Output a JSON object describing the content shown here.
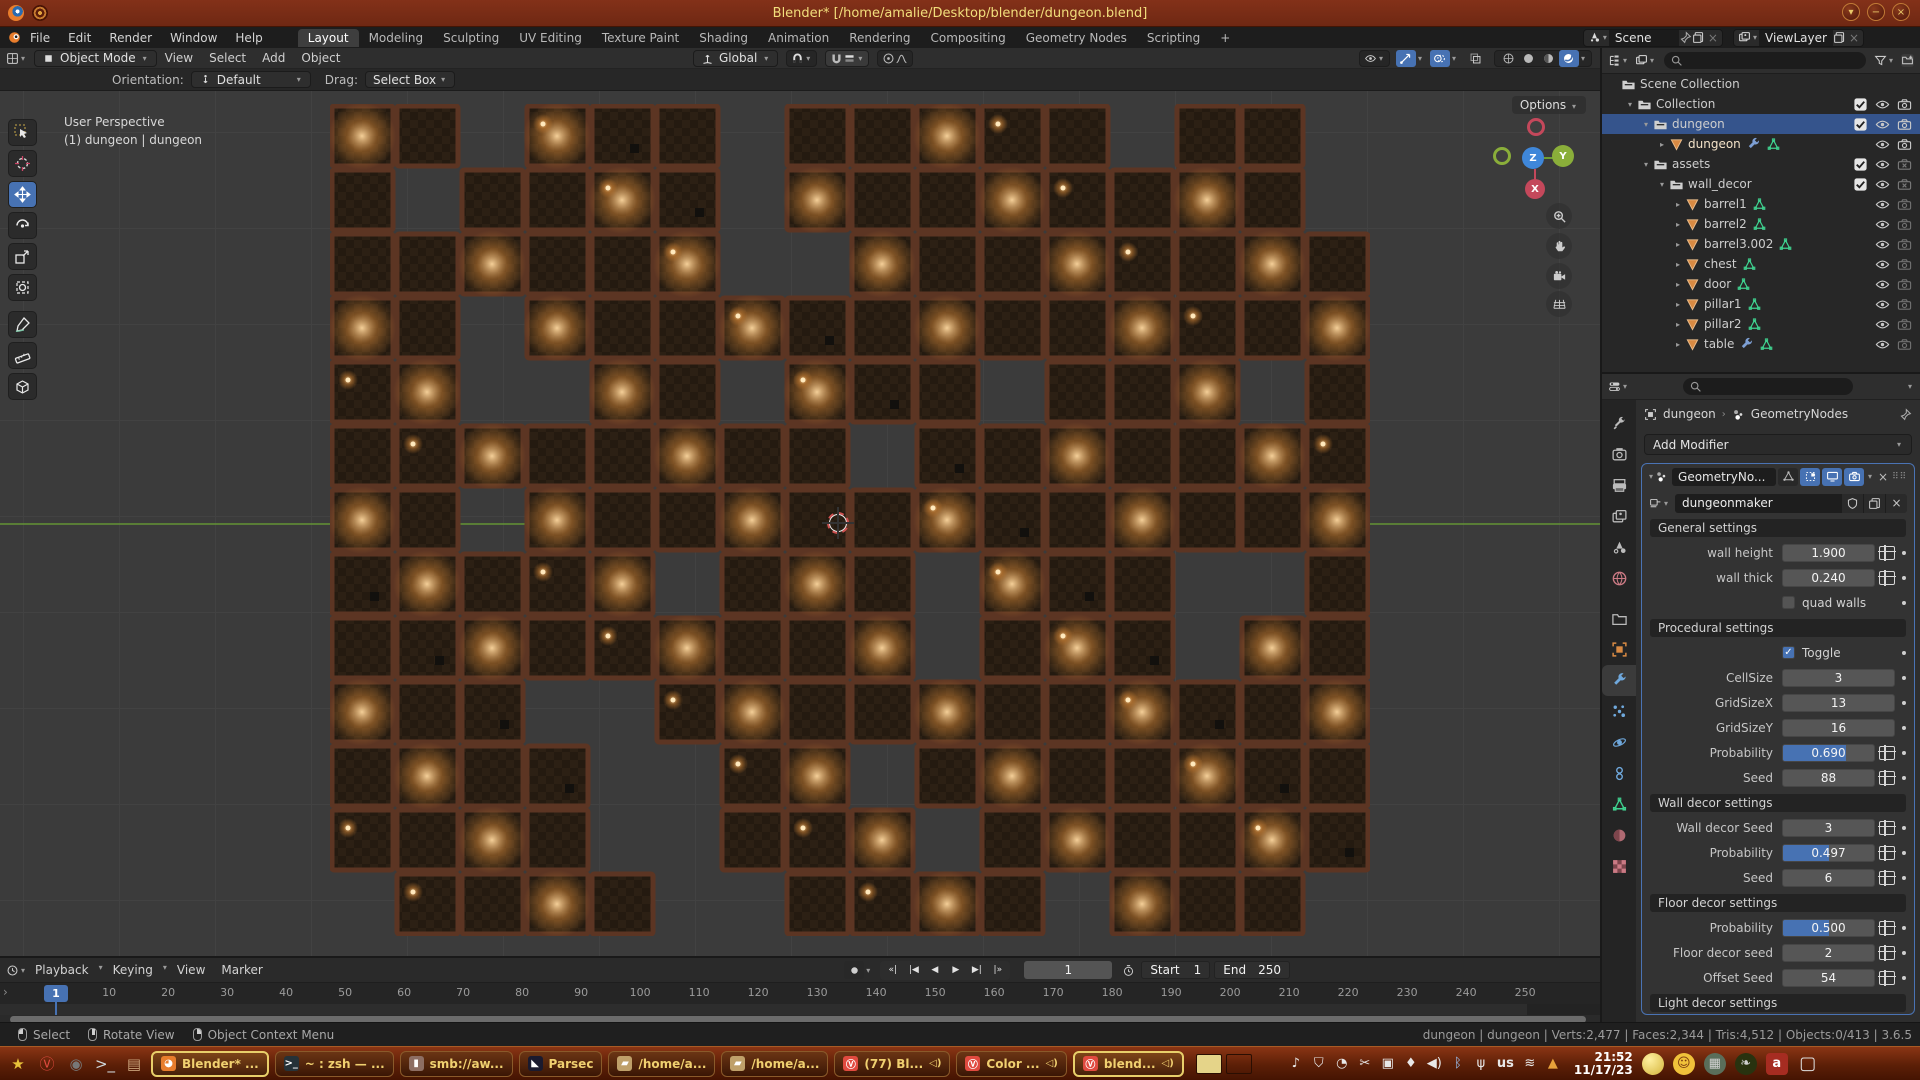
{
  "titlebar": {
    "title": "Blender* [/home/amalie/Desktop/blender/dungeon.blend]",
    "window_buttons": [
      "▾",
      "−",
      "×"
    ]
  },
  "topbar": {
    "menus": [
      "File",
      "Edit",
      "Render",
      "Window",
      "Help"
    ],
    "workspaces": [
      "Layout",
      "Modeling",
      "Sculpting",
      "UV Editing",
      "Texture Paint",
      "Shading",
      "Animation",
      "Rendering",
      "Compositing",
      "Geometry Nodes",
      "Scripting"
    ],
    "active_workspace": "Layout",
    "new_workspace": "+",
    "scene_label": "Scene",
    "viewlayer_label": "ViewLayer"
  },
  "viewport_header": {
    "mode": "Object Mode",
    "menus": [
      "View",
      "Select",
      "Add",
      "Object"
    ],
    "orientation": "Global"
  },
  "tool_settings": {
    "orientation_label": "Orientation:",
    "orientation_value": "Default",
    "drag_label": "Drag:",
    "drag_value": "Select Box",
    "options": "Options"
  },
  "viewport": {
    "overlay_line1": "User Perspective",
    "overlay_line2": "(1) dungeon | dungeon",
    "axis_z": "Z",
    "axis_y": "Y",
    "axis_x": "X",
    "map": {
      "colors": {
        "wall": "#5c3523",
        "floor_a": "#241a10",
        "floor_b": "#2c2014",
        "light_core": "#ffd9a0",
        "light_mid": "#c07a32"
      },
      "grid": [
        "##.###.#####.##.",
        "#.####.########.",
        "######..########",
        "##.#############",
        "##..##.###.###.#",
        "########.#######",
        "##.#############",
        "#####.###.###..#",
        "#########.###.##",
        "###..###########",
        "####..##.#######",
        "####..###.######",
        ".####..####.###."
      ]
    }
  },
  "outliner": {
    "rows": [
      {
        "level": 0,
        "expand": "",
        "icon": "collection",
        "label": "Scene Collection",
        "toggles": []
      },
      {
        "level": 1,
        "expand": "▾",
        "icon": "collection",
        "label": "Collection",
        "toggles": [
          "check",
          "eye",
          "camera"
        ]
      },
      {
        "level": 2,
        "expand": "▾",
        "icon": "collection",
        "label": "dungeon",
        "selected": true,
        "toggles": [
          "check",
          "eye",
          "camera"
        ]
      },
      {
        "level": 3,
        "expand": "▸",
        "icon": "mesh",
        "label": "dungeon",
        "extras": [
          "wrench",
          "nodetree"
        ],
        "active": true,
        "toggles": [
          "eye",
          "camera"
        ]
      },
      {
        "level": 2,
        "expand": "▾",
        "icon": "collection",
        "label": "assets",
        "toggles": [
          "check",
          "eye",
          "camera_off"
        ]
      },
      {
        "level": 3,
        "expand": "▾",
        "icon": "collection",
        "label": "wall_decor",
        "toggles": [
          "check",
          "eye",
          "camera_off"
        ]
      },
      {
        "level": 4,
        "expand": "▸",
        "icon": "mesh",
        "label": "barrel1",
        "extras": [
          "nodetree"
        ],
        "toggles": [
          "eye",
          "camera_dim"
        ]
      },
      {
        "level": 4,
        "expand": "▸",
        "icon": "mesh",
        "label": "barrel2",
        "extras": [
          "nodetree"
        ],
        "toggles": [
          "eye",
          "camera_dim"
        ]
      },
      {
        "level": 4,
        "expand": "▸",
        "icon": "mesh",
        "label": "barrel3.002",
        "extras": [
          "nodetree"
        ],
        "toggles": [
          "eye",
          "camera_dim"
        ]
      },
      {
        "level": 4,
        "expand": "▸",
        "icon": "mesh",
        "label": "chest",
        "extras": [
          "nodetree"
        ],
        "toggles": [
          "eye",
          "camera_dim"
        ]
      },
      {
        "level": 4,
        "expand": "▸",
        "icon": "mesh",
        "label": "door",
        "extras": [
          "nodetree"
        ],
        "toggles": [
          "eye",
          "camera_dim"
        ]
      },
      {
        "level": 4,
        "expand": "▸",
        "icon": "mesh",
        "label": "pillar1",
        "extras": [
          "nodetree"
        ],
        "toggles": [
          "eye",
          "camera_dim"
        ]
      },
      {
        "level": 4,
        "expand": "▸",
        "icon": "mesh",
        "label": "pillar2",
        "extras": [
          "nodetree"
        ],
        "toggles": [
          "eye",
          "camera_dim"
        ]
      },
      {
        "level": 4,
        "expand": "▸",
        "icon": "mesh",
        "label": "table",
        "extras": [
          "wrench",
          "nodetree"
        ],
        "toggles": [
          "eye",
          "camera_dim"
        ]
      }
    ]
  },
  "properties": {
    "tabs": [
      "tool",
      "render",
      "output",
      "viewlayer",
      "scene",
      "world",
      "collection",
      "object",
      "modifiers",
      "particles",
      "physics",
      "constraints",
      "data",
      "material",
      "texture"
    ],
    "active_tab": "modifiers",
    "breadcrumb_object": "dungeon",
    "breadcrumb_modifier": "GeometryNodes",
    "add_modifier": "Add Modifier",
    "modifier_name": "GeometryNo...",
    "node_group": "dungeonmaker",
    "sections": [
      {
        "title": "General settings",
        "rows": [
          {
            "type": "number",
            "label": "wall height",
            "value": "1.900",
            "link": true
          },
          {
            "type": "number",
            "label": "wall thick",
            "value": "0.240",
            "link": true
          },
          {
            "type": "checkbox",
            "label": "quad walls",
            "checked": false
          }
        ]
      },
      {
        "title": "Procedural settings",
        "rows": [
          {
            "type": "checkbox",
            "label": "Toggle",
            "checked": true
          },
          {
            "type": "number",
            "label": "CellSize",
            "value": "3"
          },
          {
            "type": "number",
            "label": "GridSizeX",
            "value": "13"
          },
          {
            "type": "number",
            "label": "GridSizeY",
            "value": "16"
          },
          {
            "type": "slider",
            "label": "Probability",
            "value": "0.690",
            "fill": 0.69,
            "link": true
          },
          {
            "type": "number",
            "label": "Seed",
            "value": "88",
            "link": true
          }
        ]
      },
      {
        "title": "Wall decor settings",
        "rows": [
          {
            "type": "number",
            "label": "Wall decor Seed",
            "value": "3",
            "link": true
          },
          {
            "type": "slider",
            "label": "Probability",
            "value": "0.497",
            "fill": 0.5,
            "link": true
          },
          {
            "type": "number",
            "label": "Seed",
            "value": "6",
            "link": true
          }
        ]
      },
      {
        "title": "Floor decor settings",
        "rows": [
          {
            "type": "slider",
            "label": "Probability",
            "value": "0.500",
            "fill": 0.5,
            "link": true
          },
          {
            "type": "number",
            "label": "Floor decor seed",
            "value": "2",
            "link": true
          },
          {
            "type": "number",
            "label": "Offset Seed",
            "value": "54",
            "link": true
          }
        ]
      },
      {
        "title": "Light decor settings",
        "rows": []
      }
    ]
  },
  "timeline": {
    "menus": [
      "Playback",
      "Keying",
      "View",
      "Marker"
    ],
    "current_frame": "1",
    "ticks": [
      "10",
      "20",
      "30",
      "40",
      "50",
      "60",
      "70",
      "80",
      "90",
      "100",
      "110",
      "120",
      "130",
      "140",
      "150",
      "160",
      "170",
      "180",
      "190",
      "200",
      "210",
      "220",
      "230",
      "240",
      "250"
    ],
    "frame_value": "1",
    "start_label": "Start",
    "start_value": "1",
    "end_label": "End",
    "end_value": "250",
    "transport": [
      "jump-start",
      "prev-keyframe",
      "play-reverse",
      "play",
      "next-keyframe",
      "jump-end"
    ]
  },
  "statusbar": {
    "hints": [
      {
        "button": "left",
        "label": "Select"
      },
      {
        "button": "middle",
        "label": "Rotate View"
      },
      {
        "button": "right",
        "label": "Object Context Menu"
      }
    ],
    "info": "dungeon | dungeon | Verts:2,477 | Faces:2,344 | Tris:4,512 | Objects:0/413 | 3.6.5"
  },
  "taskbar": {
    "launchers": [
      "star",
      "vivaldi",
      "disc",
      "terminal",
      "drawer"
    ],
    "tasks": [
      {
        "label": "Blender* ...",
        "icon": "blender",
        "active": true
      },
      {
        "label": "~ : zsh — ...",
        "icon": "terminal"
      },
      {
        "label": "smb://aw...",
        "icon": "drive"
      },
      {
        "label": "Parsec",
        "icon": "parsec"
      },
      {
        "label": "/home/a...",
        "icon": "folder"
      },
      {
        "label": "/home/a...",
        "icon": "folder"
      },
      {
        "label": "(77) Bl...",
        "icon": "vivaldi",
        "audio": true
      },
      {
        "label": "Color ...",
        "icon": "vivaldi",
        "audio": true
      },
      {
        "label": "blend...",
        "icon": "vivaldi",
        "audio": true,
        "active": true
      }
    ],
    "tray": [
      "music",
      "shield",
      "circle",
      "scissors",
      "pause",
      "mic",
      "volume",
      "bluetooth",
      "usb",
      "kbd",
      "wifi",
      "warning"
    ],
    "kbd_layout": "us",
    "time": "21:52",
    "date": "11/17/23",
    "right_icons": [
      "ball",
      "smiley",
      "calculator",
      "plant",
      "book",
      "window"
    ]
  }
}
